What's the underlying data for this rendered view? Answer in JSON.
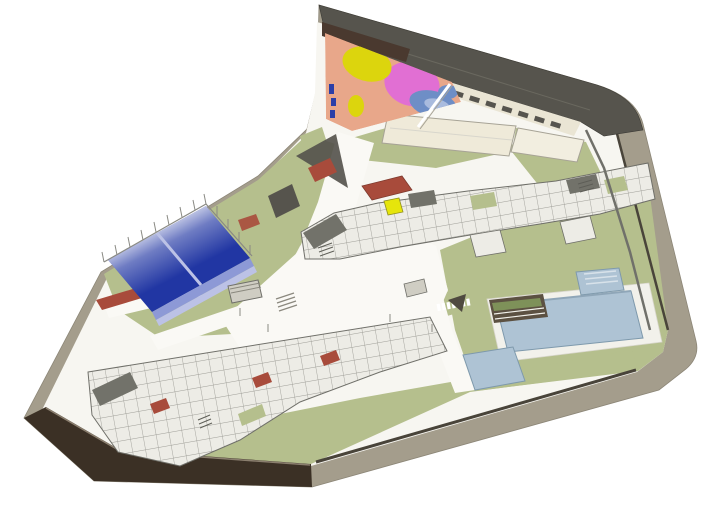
{
  "meta": {
    "scene": "architectural-axonometric-site-rendering",
    "regions": [
      "north-building",
      "playground",
      "padel-courts",
      "central-building",
      "south-building",
      "swimming-pool",
      "kids-pool",
      "perimeter-sidewalk",
      "boundary-wall"
    ]
  },
  "colors": {
    "white": "#ffffff",
    "ground_white": "#f7f6f1",
    "path_white": "#faf9f5",
    "sidewalk": "#a49d8c",
    "sidewalk_shadow": "#8c8677",
    "lawn": "#b5bf8d",
    "lawn_light": "#c6cfa3",
    "hedge_dark": "#49443a",
    "roof_dark": "#56544d",
    "roof_ridge": "#6a685f",
    "facade_cream": "#eae5d4",
    "window_dark": "#3c3b36",
    "soffit_brown": "#4a392f",
    "play_salmon": "#e8a78a",
    "play_yellow": "#dcd50d",
    "play_pink": "#e16fd3",
    "play_blue": "#6e8ec6",
    "play_blue_light": "#a9bbde",
    "play_equipment_blue": "#2b3fa8",
    "court_blue": "#2136a3",
    "court_wall": "#8d99d6",
    "court_wall_light": "#bcc2e6",
    "building_base": "#edece6",
    "building_wall": "#5e5e57",
    "building_roof_gray": "#72726a",
    "accent_terracotta": "#a84b3b",
    "accent_terracotta_dark": "#7e3a2e",
    "accent_yellow": "#e6e50b",
    "accent_yellow_edge": "#8f8f1f",
    "pool_water": "#aec3d4",
    "pool_edge": "#7e99ac",
    "pool_edge_dark": "#8fa6b8",
    "pool_step_line": "#d8e2ea",
    "deck_white": "#f2f1eb",
    "deck_edge": "#d8d6cc",
    "planter_dark": "#5c5142",
    "planter_green": "#7e9159",
    "wall_brown": "#3b3025",
    "wall_brown_light": "#8a7e6e",
    "fence_gray": "#8a8a84",
    "outline_gray": "#70706a",
    "structure_gray": "#cfcdc3",
    "structure_line": "#8a887e",
    "wing_roof_cream": "#efead9",
    "wing_roof_cream2": "#f2eee0",
    "wing_roof_edge": "#a7a396",
    "dark_wedge": "#4f4a40"
  }
}
